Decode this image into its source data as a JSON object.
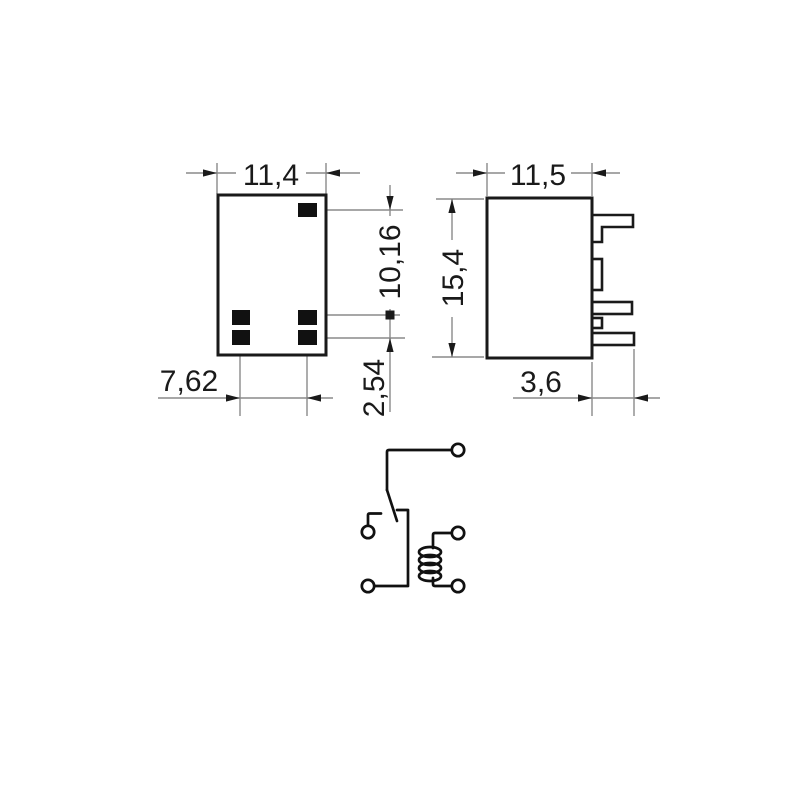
{
  "drawing": {
    "kind": "relay-technical-drawing",
    "colors": {
      "background": "#ffffff",
      "outline": "#1a1a1a",
      "dimension_line": "#8a8a8a",
      "pad_fill": "#111111"
    },
    "bottom_view": {
      "dim_body_width": "11,4",
      "dim_pin_offset": "10,16",
      "dim_pin_pitch": "2,54",
      "dim_pin_span": "7,62"
    },
    "side_view": {
      "dim_body_width": "11,5",
      "dim_body_height": "15,4",
      "dim_pin_length": "3,6"
    }
  }
}
